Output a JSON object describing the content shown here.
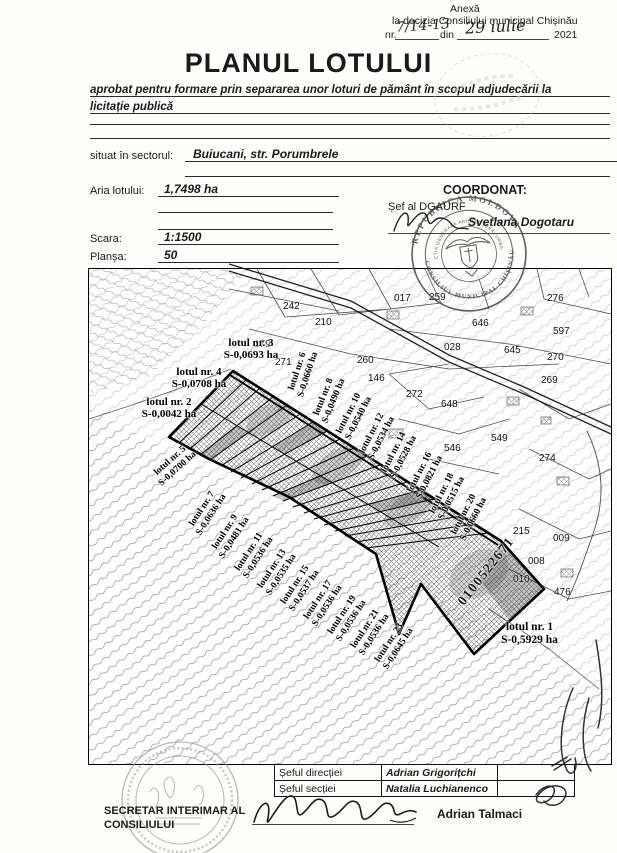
{
  "header": {
    "annex": "Anexă",
    "decision_line": "la decizia Consiliului municipal Chișinău",
    "nr_prefix": "nr.",
    "nr_value": "7/14-13",
    "din": "din",
    "date_value": "29 iulie",
    "year": "2021"
  },
  "title": "PLANUL LOTULUI",
  "subtitle_line1": "aprobat pentru formare prin separarea unor loturi de pământ în scopul adjudecării  la",
  "subtitle_line2": "licitație publică",
  "fields": {
    "sector_label": "situat  în sectorul:",
    "sector_value": "Buiucani, str. Porumbrele",
    "area_label": "Aria lotului:",
    "area_value": "1,7498 ha",
    "coordonat": "COORDONAT:",
    "sef_dgaurf": "Șef al DGAURF",
    "sef_dgaurf_name": "Svetlana Dogotaru",
    "scara_label": "Scara:",
    "scara_value": "1:1500",
    "plansa_label": "Planșa:",
    "plansa_value": "50"
  },
  "stamp": {
    "outer_top": "REPUBLICA MOLDOVA",
    "outer_bottom": "CONSILIUL MUNICIPAL CHIȘINĂU",
    "inner_ring": "DIRECȚIA GENERALĂ ARHITECTURĂ, URBANISM"
  },
  "map": {
    "cadastral_number": "0100522671",
    "lots": [
      {
        "name": "lotul nr. 1",
        "area": "S-0,5929 ha"
      },
      {
        "name": "lotul nr. 2",
        "area": "S-0,0042 ha"
      },
      {
        "name": "lotul nr. 3",
        "area": "S-0,0693 ha"
      },
      {
        "name": "lotul nr. 4",
        "area": "S-0,0708 ha"
      },
      {
        "name": "lotul nr. 5",
        "area": "S-0,0700 ha"
      },
      {
        "name": "lotul nr. 6",
        "area": "S-0,0660 ha"
      },
      {
        "name": "lotul nr. 7",
        "area": "S-0,0636 ha"
      },
      {
        "name": "lotul nr. 8",
        "area": "S-0,0490 ha"
      },
      {
        "name": "lotul nr. 9",
        "area": "S-0,0481 ha"
      },
      {
        "name": "lotul nr. 10",
        "area": "S-0,0540 ha"
      },
      {
        "name": "lotul nr. 11",
        "area": "S-0,0536 ha"
      },
      {
        "name": "lotul nr. 12",
        "area": "S-0,0534 ha"
      },
      {
        "name": "lotul nr. 13",
        "area": "S-0,0535 ha"
      },
      {
        "name": "lotul nr. 14",
        "area": "S-0,0528 ha"
      },
      {
        "name": "lotul nr. 15",
        "area": "S-0,0537 ha"
      },
      {
        "name": "lotul nr. 16",
        "area": "S-0,0821 ha"
      },
      {
        "name": "lotul nr. 17",
        "area": "S-0,0536 ha"
      },
      {
        "name": "lotul nr. 18",
        "area": "S-0,0515 ha"
      },
      {
        "name": "lotul nr. 19",
        "area": "S-0,0536 ha"
      },
      {
        "name": "lotul nr. 20",
        "area": "S-0,0660 ha"
      },
      {
        "name": "lotul nr. 21",
        "area": "S-0,0536 ha"
      },
      {
        "name": "lotul nr. 23",
        "area": "S-0,0645 ha"
      }
    ],
    "parcel_numbers": [
      "242",
      "210",
      "179",
      "271",
      "017",
      "259",
      "276",
      "646",
      "597",
      "028",
      "645",
      "270",
      "260",
      "146",
      "269",
      "272",
      "648",
      "549",
      "546",
      "274",
      "215",
      "009",
      "008",
      "010",
      "476"
    ]
  },
  "footer": {
    "rows": [
      {
        "role": "Șeful direcției",
        "name": "Adrian Grigorițchi"
      },
      {
        "role": "Șeful secției",
        "name": "Natalia Luchianenco"
      }
    ],
    "secretary_line1": "SECRETAR INTERIMAR AL",
    "secretary_line2": "CONSILIULUI",
    "secretary_name": "Adrian Talmaci"
  }
}
